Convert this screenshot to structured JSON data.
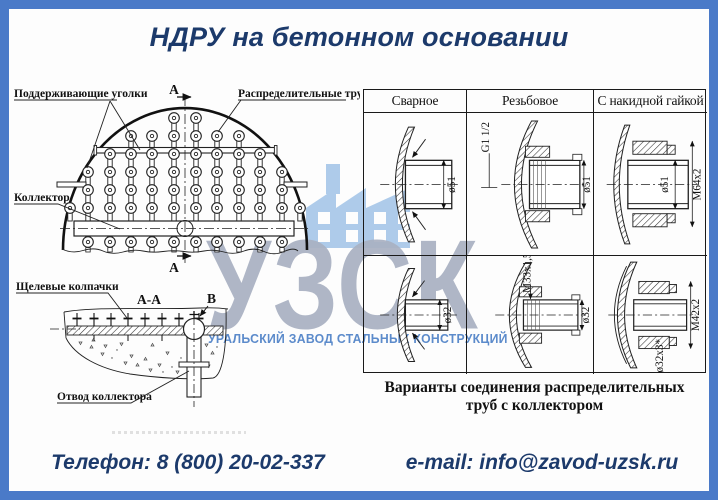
{
  "title": "НДРУ на бетонном основании",
  "top_diagram": {
    "label_supports": "Поддерживающие уголки",
    "label_distribution_pipes": "Распределительные трубы",
    "label_collector": "Коллектор",
    "section_marker_top": "А",
    "section_marker_bottom": "А"
  },
  "section_diagram": {
    "title": "А-А",
    "label_slot_caps": "Щелевые колпачки",
    "label_collector_outlet": "Отвод коллектора",
    "detail_marker": "В"
  },
  "connection_table": {
    "headers": [
      "Сварное",
      "Резьбовое",
      "С накидной гайкой"
    ],
    "cells": {
      "welded_top": {
        "dim_diameter": "ø51"
      },
      "threaded_top": {
        "dim_thread": "G1 1/2",
        "dim_diameter": "ø51"
      },
      "union_top": {
        "dim_diameter": "ø51",
        "dim_thread": "M64x2"
      },
      "welded_bottom": {
        "dim_diameter": "ø32"
      },
      "threaded_bottom": {
        "dim_thread": "M33x1,5",
        "dim_diameter": "ø32"
      },
      "union_bottom": {
        "dim_thread": "M42x2",
        "dim_diameter": "ø32x3*"
      }
    },
    "caption_line1": "Варианты соединения распределительных",
    "caption_line2": "труб с коллектором"
  },
  "watermark": {
    "logo_text": "УЗСК",
    "tagline": "УРАЛЬСКИЙ ЗАВОД СТАЛЬНЫХ КОНСТРУКЦИЙ"
  },
  "footer": {
    "phone": "Телефон: 8 (800) 20-02-337",
    "email": "e-mail: info@zavod-uzsk.ru"
  },
  "colors": {
    "frame_blue": "#4A7AC8",
    "text_navy": "#1C3A6B",
    "logo_gray": "#A9B1C2",
    "tagline_blue": "#5C8BCB",
    "building_blue": "#AECBEA"
  }
}
